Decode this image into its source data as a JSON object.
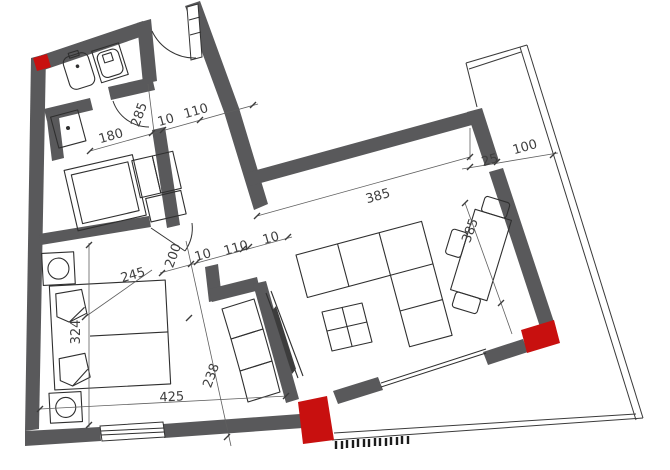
{
  "colors": {
    "wall": "#59595b",
    "accent_red": "#c8100f",
    "line": "#2f2f2f",
    "dimension_text": "#3f3f3f",
    "background": "#ffffff"
  },
  "dims": {
    "d180": "180",
    "d285": "285",
    "d10_hall": "10",
    "d110_hall": "110",
    "d25": "25",
    "d100": "100",
    "d385_living": "385",
    "d385_table": "385",
    "d200": "200",
    "d10_door_left": "10",
    "d110_door": "110",
    "d10_door_right": "10",
    "d245": "245",
    "d324": "324",
    "d425": "425",
    "d238": "238"
  }
}
